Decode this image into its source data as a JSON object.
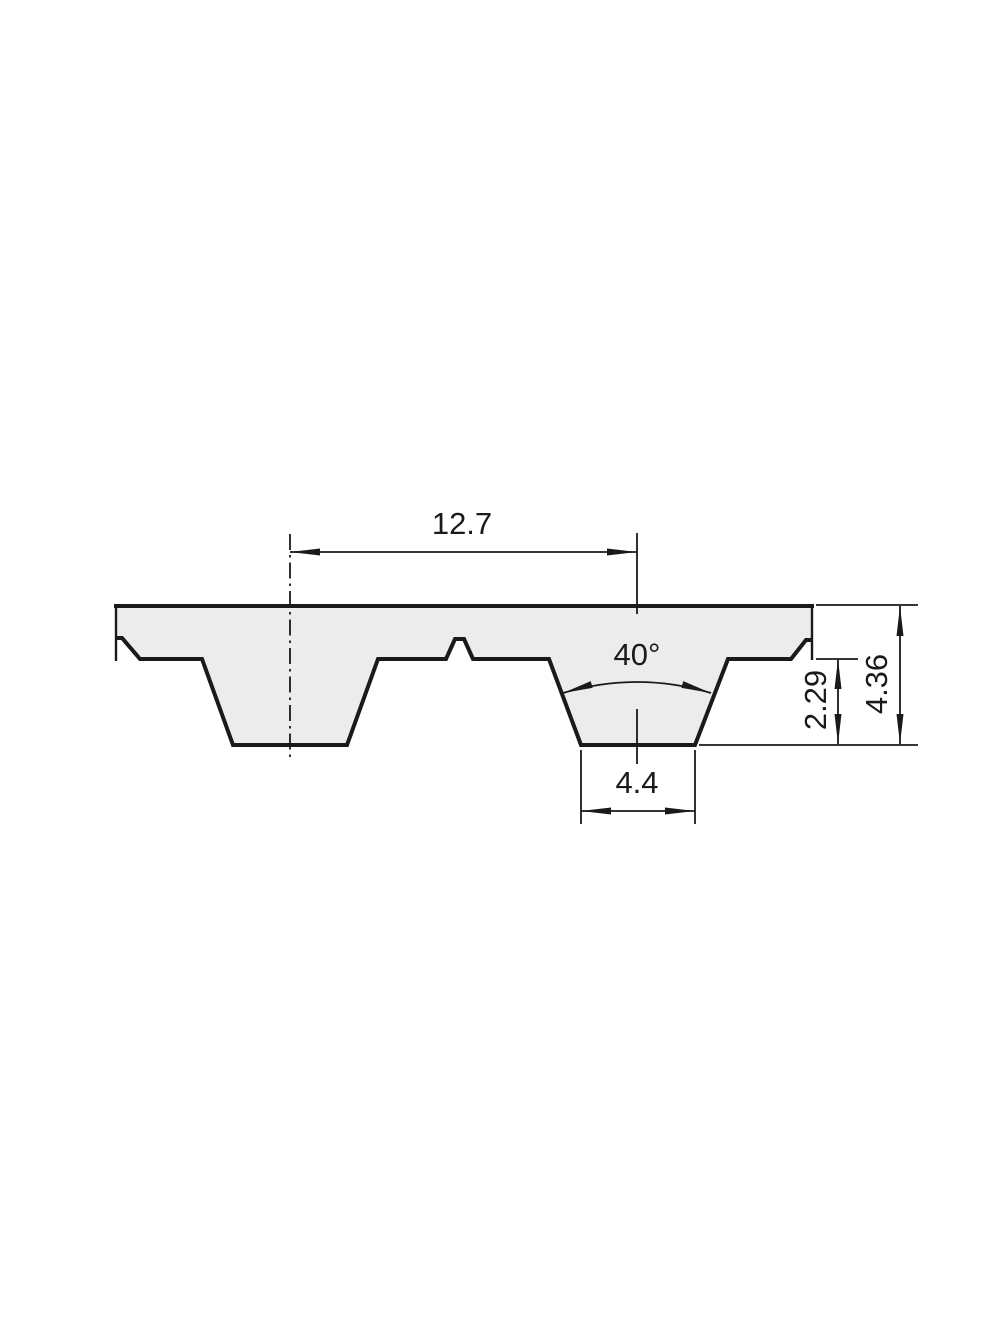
{
  "drawing": {
    "kind": "timing-belt-tooth-profile-cross-section",
    "labels": {
      "pitch": "12.7",
      "tooth_angle": "40°",
      "tooth_width": "4.4",
      "tooth_depth": "2.29",
      "belt_thickness": "4.36"
    },
    "colors": {
      "background": "#ffffff",
      "belt_fill": "#ececec",
      "line": "#1a1a1a"
    }
  }
}
